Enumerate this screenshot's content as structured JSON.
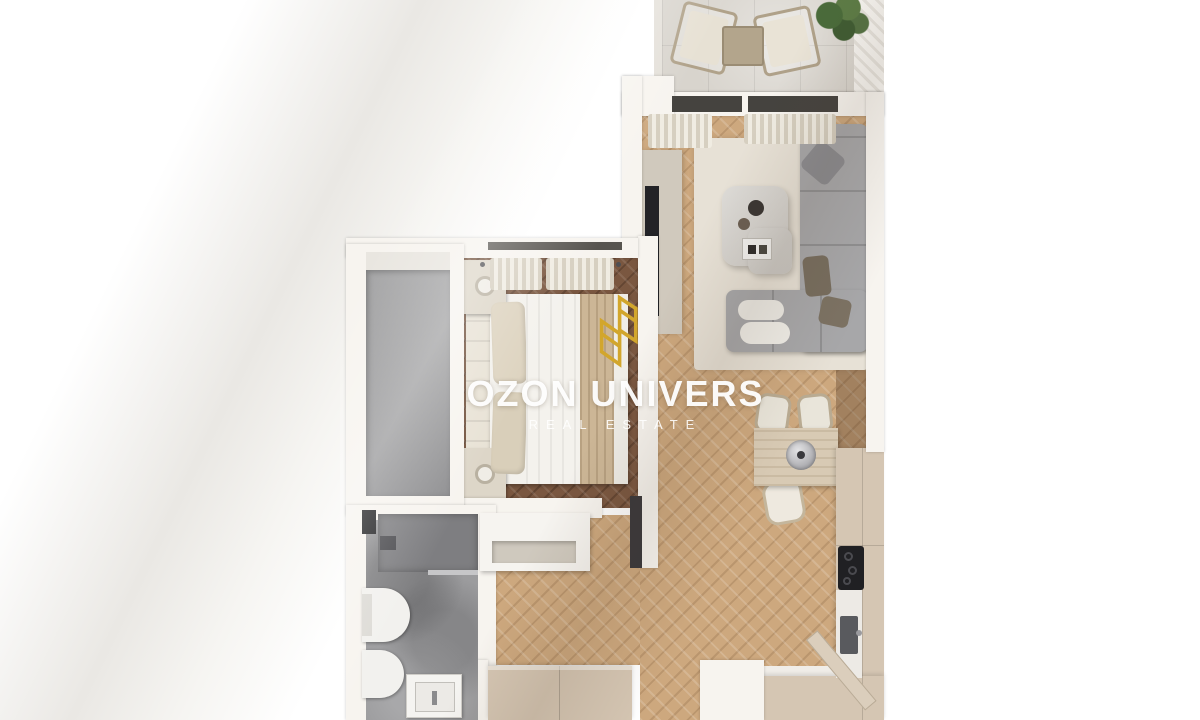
{
  "watermark": {
    "title": "OZON UNIVERS",
    "subtitle": "REAL ESTATE",
    "logo_icon": "gold-buildings-logo-icon"
  },
  "rooms": [
    "balcony",
    "living-room",
    "dining-area",
    "kitchen",
    "bedroom",
    "wardrobe",
    "bathroom",
    "hallway",
    "entrance"
  ],
  "furniture": {
    "balcony": [
      "outdoor-chair",
      "outdoor-chair",
      "outdoor-side-table",
      "potted-plant"
    ],
    "living_room": [
      "corner-sofa",
      "ottoman",
      "cushions",
      "marble-coffee-table",
      "area-rug",
      "tv-panel",
      "curtains"
    ],
    "dining_area": [
      "dining-table",
      "chair",
      "chair",
      "chair",
      "round-sink"
    ],
    "kitchen": [
      "tall-cabinets",
      "cooktop",
      "kitchen-sink",
      "lower-counter"
    ],
    "bedroom": [
      "double-bed",
      "headboard",
      "pillows",
      "nightstand-with-lamp",
      "nightstand-with-lamp",
      "curtains",
      "window"
    ],
    "bathroom": [
      "walk-in-shower",
      "glass-partition",
      "shower-head",
      "toilet",
      "bidet",
      "washbasin",
      "wall-niche"
    ],
    "hallway": [
      "console-bench",
      "built-in-wardrobe",
      "entrance-door"
    ]
  },
  "colors": {
    "background": "#ffffff",
    "wall": "#f7f4ef",
    "floor_light": "#cda87e",
    "floor_dark": "#7a5740",
    "bathroom_floor": "#9c9c9e",
    "balcony_floor": "#d8d4cd",
    "sofa": "#a7a7a9",
    "rug": "#e7e1d6",
    "kitchen_cabinet": "#d5c6b3",
    "counter_white": "#edeae5",
    "tv": "#232327",
    "cooktop": "#202023",
    "watermark_text": "#ffffff",
    "logo_gold": "#d2a62c"
  }
}
